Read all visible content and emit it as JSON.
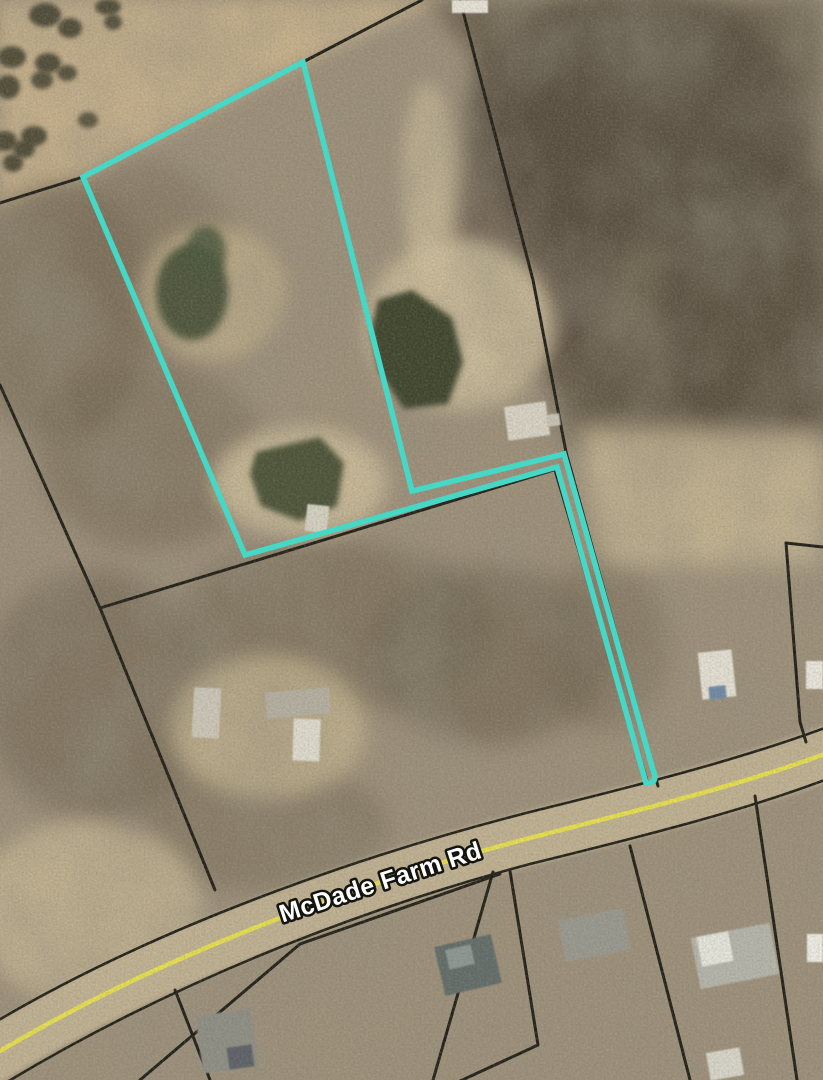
{
  "map": {
    "description": "aerial-parcel-map",
    "road_label": {
      "text": "McDade Farm Rd",
      "x": 383,
      "y": 890,
      "rotate_deg": -18,
      "font_size": 25
    },
    "colors": {
      "highlight_outline": "#45d8c7",
      "road_centerline": "#e9e14c",
      "boundary_line": "#1c1b14",
      "road_surface": "#c2b394",
      "base_terrain": "#9c8f79"
    },
    "highlight_parcel_path": "M 83 177 L 303 62 L 412 491 L 564 454 L 653 770 Q 659 784 646 783 L 557 467 L 245 555 Z",
    "shapes": [
      {
        "name": "open-field-northwest",
        "kind": "polygon",
        "points": [
          [
            0,
            0
          ],
          [
            445,
            0
          ],
          [
            303,
            62
          ],
          [
            83,
            177
          ],
          [
            0,
            208
          ]
        ],
        "fill": "#c7b18b",
        "blur": 8,
        "op": 1
      },
      {
        "name": "dense-trees-northeast",
        "kind": "polygon",
        "points": [
          [
            428,
            0
          ],
          [
            823,
            0
          ],
          [
            823,
            418
          ],
          [
            700,
            452
          ],
          [
            564,
            448
          ],
          [
            472,
            55
          ]
        ],
        "fill": "#6b5e4e",
        "blur": 10,
        "op": 0.92
      },
      {
        "name": "tree-shade",
        "kind": "ellipse",
        "cx": 635,
        "cy": 120,
        "rx": 170,
        "ry": 130,
        "fill": "#4e4537",
        "blur": 10,
        "op": 0.6
      },
      {
        "name": "tree-shade",
        "kind": "ellipse",
        "cx": 770,
        "cy": 310,
        "rx": 110,
        "ry": 150,
        "fill": "#4e4537",
        "blur": 10,
        "op": 0.55
      },
      {
        "name": "tree-shade",
        "kind": "ellipse",
        "cx": 540,
        "cy": 230,
        "rx": 80,
        "ry": 150,
        "fill": "#554a3c",
        "blur": 10,
        "op": 0.6
      },
      {
        "name": "tree-shade",
        "kind": "ellipse",
        "cx": 700,
        "cy": 390,
        "rx": 130,
        "ry": 75,
        "fill": "#5a4f41",
        "blur": 10,
        "op": 0.5
      },
      {
        "name": "scrub-shade",
        "kind": "ellipse",
        "cx": 60,
        "cy": 310,
        "rx": 95,
        "ry": 130,
        "fill": "#6e6350",
        "blur": 12,
        "op": 0.55
      },
      {
        "name": "scrub-shade",
        "kind": "ellipse",
        "cx": 150,
        "cy": 455,
        "rx": 115,
        "ry": 95,
        "fill": "#6e6350",
        "blur": 12,
        "op": 0.5
      },
      {
        "name": "scrub-shade",
        "kind": "ellipse",
        "cx": 95,
        "cy": 695,
        "rx": 115,
        "ry": 125,
        "fill": "#6a5f4d",
        "blur": 12,
        "op": 0.55
      },
      {
        "name": "scrub-shade",
        "kind": "ellipse",
        "cx": 330,
        "cy": 625,
        "rx": 160,
        "ry": 85,
        "fill": "#6e6350",
        "blur": 12,
        "op": 0.55
      },
      {
        "name": "scrub-shade",
        "kind": "ellipse",
        "cx": 490,
        "cy": 655,
        "rx": 120,
        "ry": 90,
        "fill": "#665c4a",
        "blur": 12,
        "op": 0.55
      },
      {
        "name": "scrub-shade",
        "kind": "ellipse",
        "cx": 240,
        "cy": 825,
        "rx": 150,
        "ry": 65,
        "fill": "#746a56",
        "blur": 12,
        "op": 0.5
      },
      {
        "name": "scrub-shade",
        "kind": "ellipse",
        "cx": 605,
        "cy": 645,
        "rx": 65,
        "ry": 85,
        "fill": "#6e6350",
        "blur": 12,
        "op": 0.45
      },
      {
        "name": "scrub-shade",
        "kind": "ellipse",
        "cx": 150,
        "cy": 255,
        "rx": 85,
        "ry": 95,
        "fill": "#776b54",
        "blur": 12,
        "op": 0.5
      },
      {
        "name": "clearing",
        "kind": "ellipse",
        "cx": 213,
        "cy": 293,
        "rx": 72,
        "ry": 66,
        "fill": "#c2b08a",
        "blur": 9,
        "op": 0.8
      },
      {
        "name": "sand-flat",
        "kind": "ellipse",
        "cx": 460,
        "cy": 325,
        "rx": 95,
        "ry": 85,
        "fill": "#cfbf9c",
        "blur": 9,
        "op": 0.9
      },
      {
        "name": "sand-flat",
        "kind": "ellipse",
        "cx": 300,
        "cy": 482,
        "rx": 88,
        "ry": 55,
        "fill": "#cfbf9c",
        "blur": 9,
        "op": 0.85
      },
      {
        "name": "sand-flat",
        "kind": "polygon",
        "points": [
          [
            575,
            425
          ],
          [
            823,
            430
          ],
          [
            823,
            565
          ],
          [
            608,
            565
          ]
        ],
        "fill": "#c8b794",
        "blur": 12,
        "op": 0.85
      },
      {
        "name": "clearing",
        "kind": "ellipse",
        "cx": 88,
        "cy": 912,
        "rx": 115,
        "ry": 92,
        "fill": "#c8b794",
        "blur": 10,
        "op": 0.8
      },
      {
        "name": "clearing",
        "kind": "ellipse",
        "cx": 268,
        "cy": 727,
        "rx": 98,
        "ry": 72,
        "fill": "#c2b28e",
        "blur": 10,
        "op": 0.8
      },
      {
        "name": "sand-trail",
        "kind": "ellipse",
        "cx": 428,
        "cy": 180,
        "rx": 26,
        "ry": 98,
        "fill": "#cfbf9c",
        "blur": 8,
        "op": 0.7
      },
      {
        "name": "terrain-mottle",
        "kind": "rect",
        "x": 0,
        "y": 0,
        "w": 823,
        "h": 1080,
        "filter": "mottle",
        "op": 0.5
      },
      {
        "name": "pond-large",
        "kind": "polygon",
        "points": [
          [
            378,
            300
          ],
          [
            412,
            290
          ],
          [
            452,
            318
          ],
          [
            463,
            362
          ],
          [
            448,
            404
          ],
          [
            404,
            409
          ],
          [
            379,
            372
          ],
          [
            371,
            331
          ]
        ],
        "fill": "#3a432b",
        "blur": 3,
        "op": 1
      },
      {
        "name": "pond-small",
        "kind": "polygon",
        "points": [
          [
            256,
            452
          ],
          [
            320,
            437
          ],
          [
            344,
            463
          ],
          [
            337,
            506
          ],
          [
            299,
            521
          ],
          [
            261,
            506
          ],
          [
            250,
            474
          ]
        ],
        "fill": "#4a5134",
        "blur": 3,
        "op": 1
      },
      {
        "name": "field-tree",
        "kind": "ellipse",
        "cx": 45,
        "cy": 15,
        "rx": 16,
        "ry": 12,
        "fill": "#42402f",
        "blur": 2,
        "op": 0.9
      },
      {
        "name": "field-tree",
        "kind": "ellipse",
        "cx": 70,
        "cy": 28,
        "rx": 12,
        "ry": 10,
        "fill": "#42402f",
        "blur": 2,
        "op": 0.9
      },
      {
        "name": "field-tree",
        "kind": "ellipse",
        "cx": 12,
        "cy": 57,
        "rx": 14,
        "ry": 11,
        "fill": "#42402f",
        "blur": 2,
        "op": 0.9
      },
      {
        "name": "field-tree",
        "kind": "ellipse",
        "cx": 48,
        "cy": 63,
        "rx": 13,
        "ry": 10,
        "fill": "#42402f",
        "blur": 2,
        "op": 0.9
      },
      {
        "name": "field-tree",
        "kind": "ellipse",
        "cx": 8,
        "cy": 87,
        "rx": 12,
        "ry": 12,
        "fill": "#42402f",
        "blur": 2,
        "op": 0.9
      },
      {
        "name": "field-tree",
        "kind": "ellipse",
        "cx": 42,
        "cy": 80,
        "rx": 11,
        "ry": 9,
        "fill": "#42402f",
        "blur": 2,
        "op": 0.85
      },
      {
        "name": "field-tree",
        "kind": "ellipse",
        "cx": 67,
        "cy": 73,
        "rx": 10,
        "ry": 8,
        "fill": "#42402f",
        "blur": 2,
        "op": 0.85
      },
      {
        "name": "field-tree",
        "kind": "ellipse",
        "cx": 108,
        "cy": 7,
        "rx": 13,
        "ry": 8,
        "fill": "#42402f",
        "blur": 2,
        "op": 0.9
      },
      {
        "name": "field-tree",
        "kind": "ellipse",
        "cx": 113,
        "cy": 22,
        "rx": 9,
        "ry": 8,
        "fill": "#42402f",
        "blur": 2,
        "op": 0.85
      },
      {
        "name": "field-tree",
        "kind": "ellipse",
        "cx": 5,
        "cy": 141,
        "rx": 12,
        "ry": 10,
        "fill": "#42402f",
        "blur": 2,
        "op": 0.9
      },
      {
        "name": "field-tree",
        "kind": "ellipse",
        "cx": 34,
        "cy": 136,
        "rx": 13,
        "ry": 10,
        "fill": "#42402f",
        "blur": 2,
        "op": 0.9
      },
      {
        "name": "field-tree",
        "kind": "ellipse",
        "cx": 24,
        "cy": 149,
        "rx": 11,
        "ry": 9,
        "fill": "#42402f",
        "blur": 2,
        "op": 0.9
      },
      {
        "name": "field-tree",
        "kind": "ellipse",
        "cx": 13,
        "cy": 163,
        "rx": 10,
        "ry": 9,
        "fill": "#42402f",
        "blur": 2,
        "op": 0.9
      },
      {
        "name": "field-tree",
        "kind": "ellipse",
        "cx": 88,
        "cy": 120,
        "rx": 10,
        "ry": 8,
        "fill": "#42402f",
        "blur": 2,
        "op": 0.8
      },
      {
        "name": "bush-cluster",
        "kind": "ellipse",
        "cx": 192,
        "cy": 292,
        "rx": 36,
        "ry": 48,
        "fill": "#3f4c33",
        "blur": 4,
        "op": 0.9
      },
      {
        "name": "bush-cluster",
        "kind": "ellipse",
        "cx": 206,
        "cy": 252,
        "rx": 20,
        "ry": 26,
        "fill": "#47543a",
        "blur": 4,
        "op": 0.85
      },
      {
        "name": "road-surface",
        "kind": "path",
        "d": "M -8,1056 C 150,960 350,885 530,838 C 660,805 750,782 830,752",
        "fill": "none",
        "stroke": "#c2b394",
        "sw": 54,
        "op": 0.95,
        "blur": 2
      },
      {
        "name": "road-edge-north",
        "kind": "path",
        "d": "M -8,1024 C 150,930 350,858 530,812 C 660,780 750,756 830,726",
        "fill": "none",
        "stroke": "#1c1b14",
        "sw": 2.6
      },
      {
        "name": "road-edge-south",
        "kind": "path",
        "d": "M -6,1090 C 160,988 350,912 530,864 C 660,832 752,808 830,778",
        "fill": "none",
        "stroke": "#1c1b14",
        "sw": 2.6
      },
      {
        "name": "parcel-boundary",
        "kind": "polyline",
        "points": [
          [
            0,
            203
          ],
          [
            83,
            177
          ],
          [
            303,
            62
          ],
          [
            422,
            0
          ]
        ],
        "stroke": "#1c1b14",
        "sw": 3
      },
      {
        "name": "parcel-boundary",
        "kind": "polyline",
        "points": [
          [
            460,
            0
          ],
          [
            533,
            280
          ],
          [
            566,
            452
          ],
          [
            658,
            786
          ]
        ],
        "stroke": "#1c1b14",
        "sw": 3
      },
      {
        "name": "parcel-boundary",
        "kind": "polyline",
        "points": [
          [
            555,
            470
          ],
          [
            648,
            784
          ]
        ],
        "stroke": "#1c1b14",
        "sw": 3
      },
      {
        "name": "parcel-boundary",
        "kind": "polyline",
        "points": [
          [
            0,
            385
          ],
          [
            100,
            608
          ],
          [
            557,
            469
          ]
        ],
        "stroke": "#1c1b14",
        "sw": 3
      },
      {
        "name": "parcel-boundary",
        "kind": "polyline",
        "points": [
          [
            100,
            608
          ],
          [
            215,
            890
          ]
        ],
        "stroke": "#1c1b14",
        "sw": 3
      },
      {
        "name": "parcel-boundary",
        "kind": "polyline",
        "points": [
          [
            786,
            543
          ],
          [
            823,
            547
          ]
        ],
        "stroke": "#1c1b14",
        "sw": 3
      },
      {
        "name": "parcel-boundary",
        "kind": "polyline",
        "points": [
          [
            786,
            543
          ],
          [
            800,
            722
          ],
          [
            806,
            742
          ]
        ],
        "stroke": "#1c1b14",
        "sw": 3
      },
      {
        "name": "parcel-boundary",
        "kind": "polyline",
        "points": [
          [
            493,
            872
          ],
          [
            433,
            1080
          ]
        ],
        "stroke": "#1c1b14",
        "sw": 3
      },
      {
        "name": "parcel-boundary",
        "kind": "polyline",
        "points": [
          [
            510,
            871
          ],
          [
            538,
            1045
          ],
          [
            458,
            1082
          ]
        ],
        "stroke": "#1c1b14",
        "sw": 3
      },
      {
        "name": "parcel-boundary",
        "kind": "polyline",
        "points": [
          [
            630,
            846
          ],
          [
            690,
            1080
          ]
        ],
        "stroke": "#1c1b14",
        "sw": 3
      },
      {
        "name": "parcel-boundary",
        "kind": "polyline",
        "points": [
          [
            755,
            796
          ],
          [
            797,
            1080
          ]
        ],
        "stroke": "#1c1b14",
        "sw": 3
      },
      {
        "name": "parcel-boundary",
        "kind": "polyline",
        "points": [
          [
            500,
            874
          ],
          [
            300,
            944
          ],
          [
            140,
            1080
          ]
        ],
        "stroke": "#1c1b14",
        "sw": 3
      },
      {
        "name": "parcel-boundary",
        "kind": "polyline",
        "points": [
          [
            175,
            990
          ],
          [
            210,
            1080
          ]
        ],
        "stroke": "#1c1b14",
        "sw": 3
      },
      {
        "name": "road-centerline",
        "kind": "path",
        "d": "M -8,1056 C 150,960 350,885 530,838 C 660,805 750,782 830,752",
        "fill": "none",
        "stroke": "#e9e14c",
        "sw": 4.5
      },
      {
        "name": "building",
        "kind": "rect",
        "x": 452,
        "y": 0,
        "w": 36,
        "h": 13,
        "fill": "#e9e5da",
        "rot": 0,
        "blur": 1
      },
      {
        "name": "building",
        "kind": "rect",
        "x": 506,
        "y": 404,
        "w": 42,
        "h": 34,
        "fill": "#d9d4c6",
        "rot": -8,
        "blur": 1
      },
      {
        "name": "building",
        "kind": "rect",
        "x": 547,
        "y": 414,
        "w": 13,
        "h": 12,
        "fill": "#c9c4b6",
        "rot": -8,
        "blur": 1
      },
      {
        "name": "pond-dock",
        "kind": "rect",
        "x": 306,
        "y": 505,
        "w": 22,
        "h": 27,
        "fill": "#d6d2c4",
        "rot": 6,
        "blur": 1
      },
      {
        "name": "building",
        "kind": "rect",
        "x": 193,
        "y": 688,
        "w": 27,
        "h": 50,
        "fill": "#cdc7ba",
        "rot": 3,
        "blur": 1
      },
      {
        "name": "building",
        "kind": "rect",
        "x": 266,
        "y": 690,
        "w": 64,
        "h": 26,
        "fill": "#b5afa2",
        "rot": -5,
        "blur": 1
      },
      {
        "name": "building",
        "kind": "rect",
        "x": 293,
        "y": 719,
        "w": 27,
        "h": 42,
        "fill": "#e0dcd1",
        "rot": 2,
        "blur": 1
      },
      {
        "name": "building",
        "kind": "rect",
        "x": 700,
        "y": 651,
        "w": 34,
        "h": 47,
        "fill": "#e5e1d6",
        "rot": -6,
        "blur": 1
      },
      {
        "name": "pool",
        "kind": "rect",
        "x": 709,
        "y": 686,
        "w": 17,
        "h": 13,
        "fill": "#6d88a6",
        "rot": -6,
        "blur": 1
      },
      {
        "name": "building",
        "kind": "rect",
        "x": 806,
        "y": 661,
        "w": 17,
        "h": 28,
        "fill": "#ebe9e0",
        "rot": 0,
        "blur": 1
      },
      {
        "name": "building",
        "kind": "rect",
        "x": 439,
        "y": 940,
        "w": 58,
        "h": 50,
        "fill": "#5f6a68",
        "rot": -13,
        "blur": 1
      },
      {
        "name": "building",
        "kind": "rect",
        "x": 447,
        "y": 947,
        "w": 26,
        "h": 20,
        "fill": "#8b9693",
        "rot": -13,
        "blur": 1
      },
      {
        "name": "building",
        "kind": "rect",
        "x": 561,
        "y": 914,
        "w": 66,
        "h": 42,
        "fill": "#989890",
        "rot": -11,
        "blur": 1
      },
      {
        "name": "building",
        "kind": "rect",
        "x": 695,
        "y": 930,
        "w": 80,
        "h": 52,
        "fill": "#b5b5ad",
        "rot": -11,
        "blur": 1
      },
      {
        "name": "building",
        "kind": "rect",
        "x": 699,
        "y": 934,
        "w": 32,
        "h": 30,
        "fill": "#e7e7df",
        "rot": -11,
        "blur": 1
      },
      {
        "name": "building",
        "kind": "rect",
        "x": 807,
        "y": 934,
        "w": 16,
        "h": 28,
        "fill": "#efefe8",
        "rot": 0,
        "blur": 1
      },
      {
        "name": "building",
        "kind": "rect",
        "x": 199,
        "y": 1012,
        "w": 56,
        "h": 58,
        "fill": "#8d8d85",
        "rot": -8,
        "blur": 1
      },
      {
        "name": "building",
        "kind": "rect",
        "x": 228,
        "y": 1046,
        "w": 25,
        "h": 22,
        "fill": "#5a5f66",
        "rot": -8,
        "blur": 1
      },
      {
        "name": "building",
        "kind": "rect",
        "x": 708,
        "y": 1050,
        "w": 34,
        "h": 28,
        "fill": "#d9d7cc",
        "rot": -10,
        "blur": 1
      },
      {
        "name": "terrain-grain",
        "kind": "rect",
        "x": 0,
        "y": 0,
        "w": 823,
        "h": 1080,
        "filter": "grain",
        "op": 0.3
      },
      {
        "name": "terrain-grain-light",
        "kind": "rect",
        "x": 0,
        "y": 0,
        "w": 823,
        "h": 1080,
        "filter": "grainlight",
        "op": 0.18
      }
    ]
  }
}
